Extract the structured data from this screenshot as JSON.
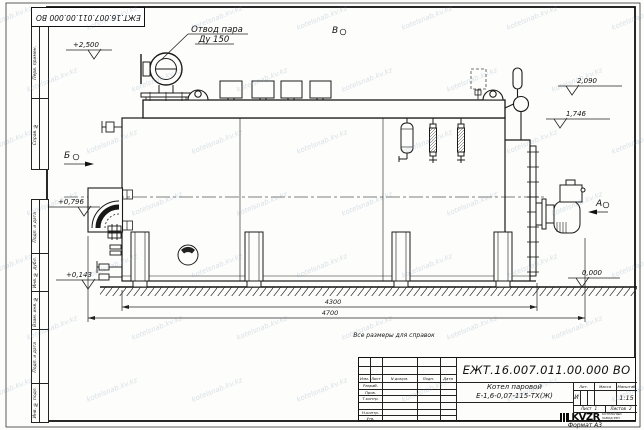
{
  "watermark": "kotelsnab.kv.kz",
  "corner_stamp": "ЕЖТ.16.007.011.00.000  ВО",
  "margin_labels": [
    "Перв. примен.",
    "Справ. №",
    "Подп. и дата",
    "Инв. № дубл.",
    "Взам. инв. №",
    "Подп. и дата",
    "Инв. № подл."
  ],
  "annotations": {
    "steam_outlet_line1": "Отвод пара",
    "steam_outlet_line2": "Ду 150",
    "elev_plus2500": "+2,500",
    "elev_2090": "2,090",
    "elev_1746": "1,746",
    "elev_plus0796": "+0,796",
    "elev_plus0143": "+0,143",
    "elev_zero": "0,000",
    "dim_4300": "4300",
    "dim_4700": "4700",
    "view_v": "В",
    "view_b": "Б",
    "view_a": "А",
    "note": "Все размеры для справок"
  },
  "title_block": {
    "doc_number": "ЕЖТ.16.007.011.00.000  ВО",
    "product_line1": "Котел паровой",
    "product_line2": "Е-1,6-0,07-115-ТХ(Ж)",
    "col_headers": [
      "Изм.",
      "Лист",
      "N докум.",
      "Подп.",
      "Дата"
    ],
    "row_labels": [
      "Разраб.",
      "Пров.",
      "Т.контр.",
      "Н.контр.",
      "Утв."
    ],
    "lit_label": "Лит.",
    "mass_label": "Масса",
    "scale_label": "Масштаб",
    "lit_value": "И",
    "scale_value": "1:15",
    "sheet_label": "Лист",
    "sheet_value": "1",
    "sheets_label": "Листов",
    "sheets_value": "2",
    "logo": "KVZR",
    "company_line1": "КОТЕЛЬНЫЙ",
    "company_line2": "ЗАВОД РЭП",
    "format": "Формат А3"
  }
}
